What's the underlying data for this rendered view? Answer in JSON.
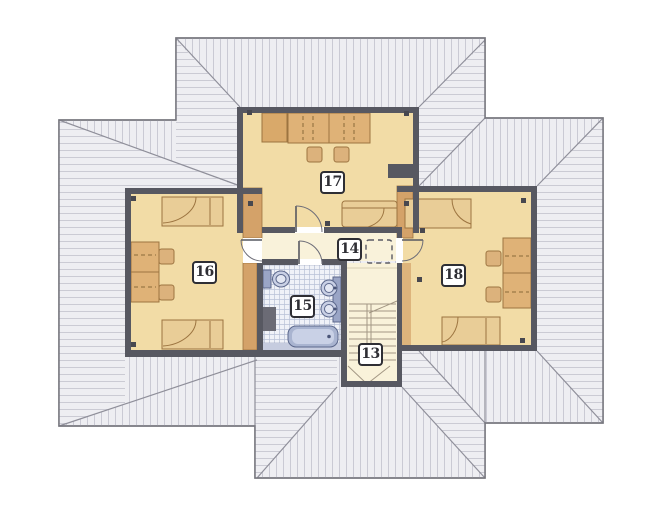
{
  "plan": {
    "title": "attic floor plan",
    "rooms": [
      {
        "number": "13",
        "kind": "staircase"
      },
      {
        "number": "14",
        "kind": "hall"
      },
      {
        "number": "15",
        "kind": "bathroom"
      },
      {
        "number": "16",
        "kind": "room-left"
      },
      {
        "number": "17",
        "kind": "room-top"
      },
      {
        "number": "18",
        "kind": "room-right"
      }
    ],
    "palette": {
      "roof_fill": "#eeeef2",
      "roof_hatch": "#c7c7d1",
      "roof_edge": "#77777f",
      "wall": "#575861",
      "room_floor": "#f2dca6",
      "hall_floor": "#f9f2da",
      "wood_wall": "#d4a269",
      "furniture": "#dfb277",
      "bed": "#e9cd97",
      "furniture_line": "#9c7440",
      "bath_fixture": "#9aa5c6",
      "bath_fixture_light": "#c9d0e5",
      "bath_floor": "#c6ccdf",
      "tile_line": "#b9c1d7",
      "label_ink": "#2e2e34"
    }
  }
}
